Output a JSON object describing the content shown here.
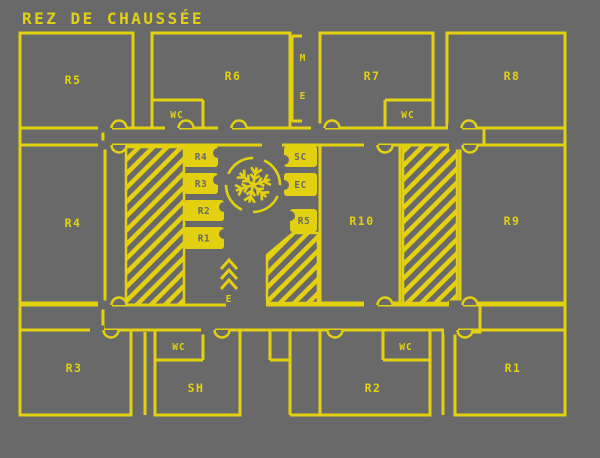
{
  "title": "REZ DE CHAUSSÉE",
  "colors": {
    "background": "#696969",
    "plan_yellow": "#e3d111"
  },
  "rooms": {
    "r5": {
      "label": "R5"
    },
    "r6": {
      "label": "R6"
    },
    "r7": {
      "label": "R7"
    },
    "r8": {
      "label": "R8"
    },
    "r4": {
      "label": "R4"
    },
    "r10": {
      "label": "R10"
    },
    "r9": {
      "label": "R9"
    },
    "r3": {
      "label": "R3"
    },
    "sh": {
      "label": "SH"
    },
    "r2": {
      "label": "R2"
    },
    "r1": {
      "label": "R1"
    }
  },
  "wc": {
    "in_r6": "WC",
    "in_r7": "WC",
    "in_sh": "WC",
    "in_r2": "WC"
  },
  "shaft": {
    "m": "M",
    "e": "E"
  },
  "closets": {
    "left_stack": {
      "c1": "R4",
      "c2": "R3",
      "c3": "R2",
      "c4": "R1"
    },
    "right_stack": {
      "sc": "SC",
      "ec": "EC",
      "r5": "R5"
    }
  },
  "escalator": {
    "label": "E"
  },
  "symbols": {
    "center": "snowflake-icon"
  }
}
